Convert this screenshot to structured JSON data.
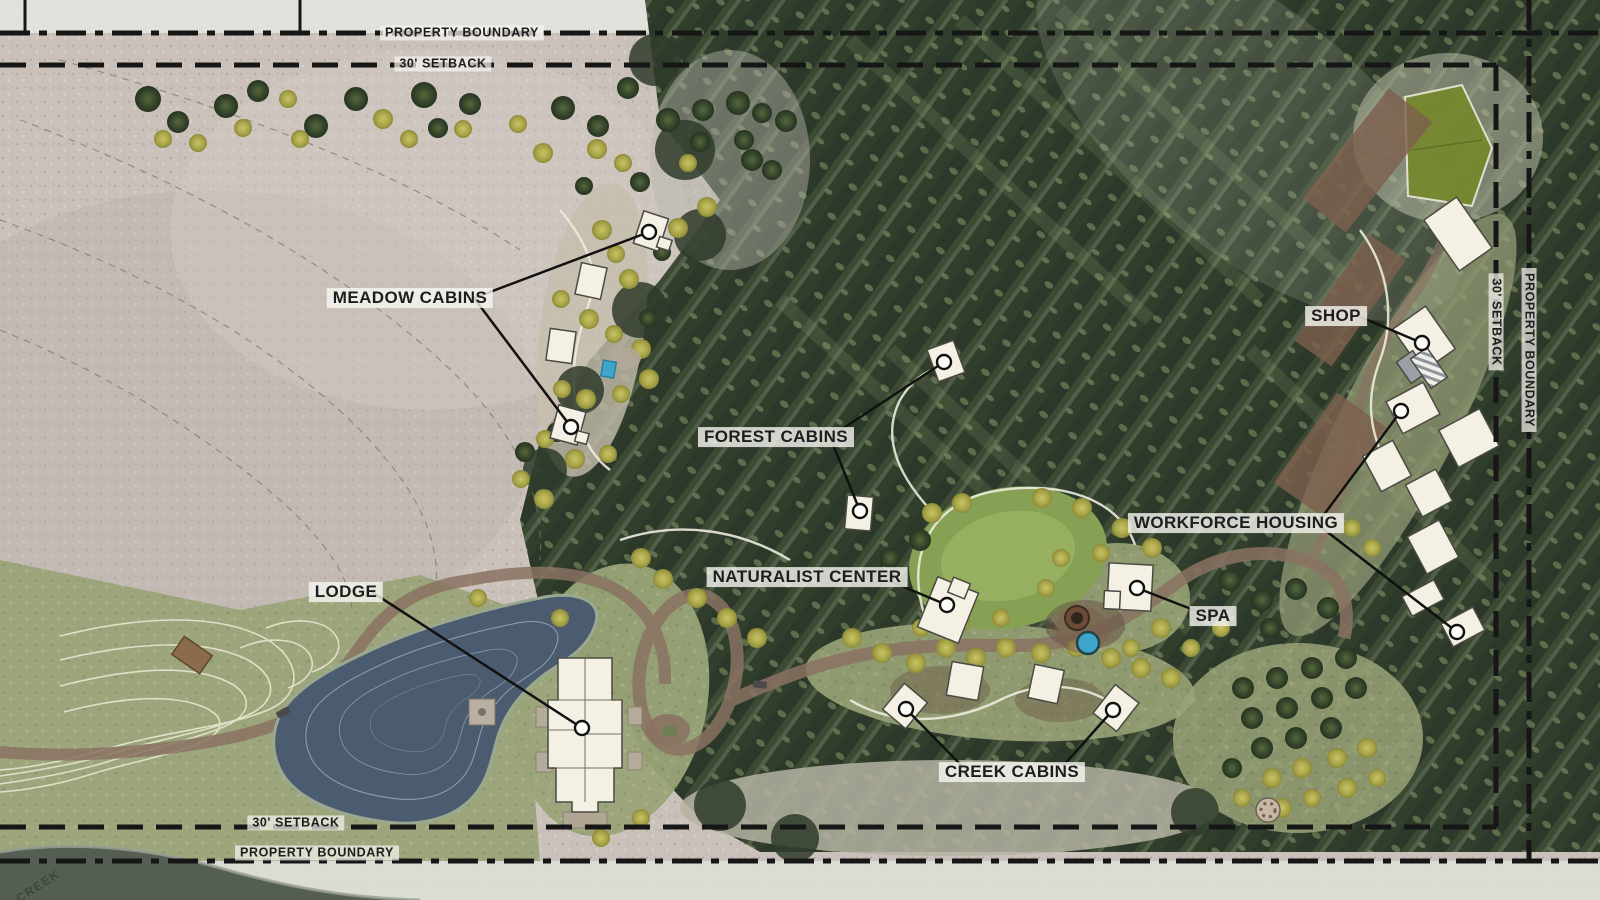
{
  "map": {
    "title": "Resort site master plan",
    "boundaries": {
      "top_property": "PROPERTY BOUNDARY",
      "top_setback": "30' SETBACK",
      "bottom_setback": "30' SETBACK",
      "bottom_property": "PROPERTY BOUNDARY",
      "right_setback": "30' SETBACK",
      "right_property": "PROPERTY BOUNDARY"
    },
    "features": {
      "meadow_cabins": {
        "label": "MEADOW CABINS"
      },
      "forest_cabins": {
        "label": "FOREST CABINS"
      },
      "naturalist_center": {
        "label": "NATURALIST CENTER"
      },
      "lodge": {
        "label": "LODGE"
      },
      "spa": {
        "label": "SPA"
      },
      "creek_cabins": {
        "label": "CREEK CABINS"
      },
      "workforce_housing": {
        "label": "WORKFORCE HOUSING"
      },
      "shop": {
        "label": "SHOP"
      }
    },
    "creek_label": "CREEK",
    "colors": {
      "boundary_line": "#161616",
      "label_text": "#1d1d1d",
      "label_bg": "#f8f7f2",
      "forest": "#323e2c",
      "meadow": "#c9c1ba",
      "lawn": "#87a154",
      "pond_water": "#4c5c70",
      "pool_water": "#3ea6cb",
      "road": "#8a7263",
      "building": "#f4f0e4"
    }
  }
}
